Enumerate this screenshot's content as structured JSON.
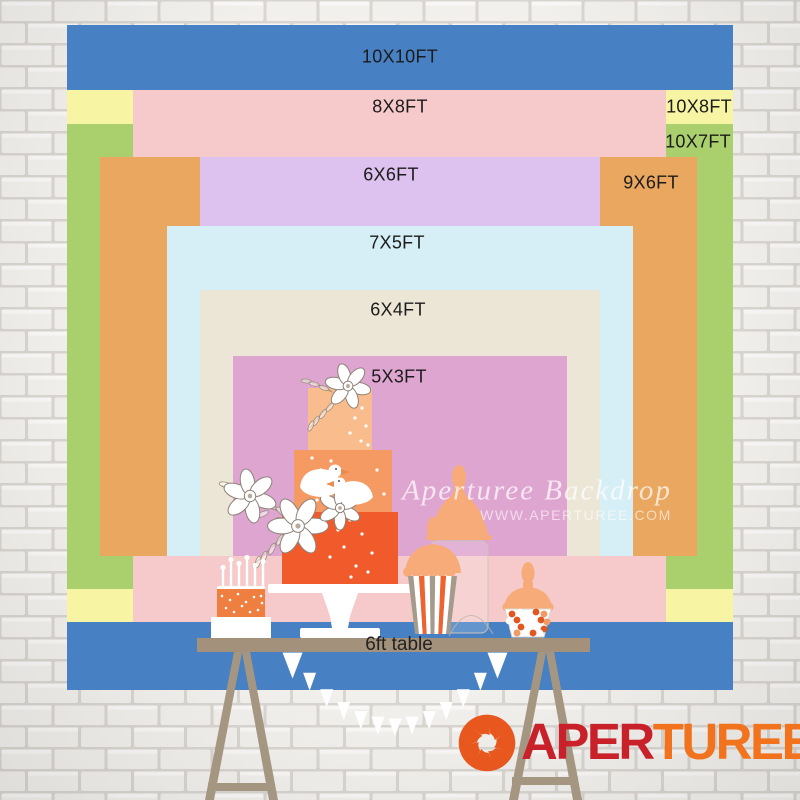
{
  "chart": {
    "unit": "FT",
    "label_color": "#1b1b1b",
    "layers": [
      {
        "id": "10x10",
        "label": "10X10FT",
        "color": "#4781c3",
        "x": 67,
        "y": 25,
        "w": 666,
        "h": 665,
        "label_x": 400,
        "label_y": 57
      },
      {
        "id": "10x8",
        "label": "10X8FT",
        "color": "#f7f5a3",
        "x": 67,
        "y": 90,
        "w": 666,
        "h": 532,
        "label_x": 699,
        "label_y": 107
      },
      {
        "id": "10x7",
        "label": "10X7FT",
        "color": "#aad06e",
        "x": 67,
        "y": 124,
        "w": 666,
        "h": 465,
        "label_x": 698,
        "label_y": 142
      },
      {
        "id": "8x8",
        "label": "8X8FT",
        "color": "#f6caca",
        "x": 133,
        "y": 90,
        "w": 533,
        "h": 532,
        "label_x": 400,
        "label_y": 107
      },
      {
        "id": "9x6",
        "label": "9X6FT",
        "color": "#eaa75f",
        "x": 100,
        "y": 157,
        "w": 597,
        "h": 399,
        "label_x": 651,
        "label_y": 183
      },
      {
        "id": "6x6",
        "label": "6X6FT",
        "color": "#ddc1ee",
        "x": 200,
        "y": 157,
        "w": 400,
        "h": 399,
        "label_x": 391,
        "label_y": 175
      },
      {
        "id": "7x5",
        "label": "7X5FT",
        "color": "#d6eef6",
        "x": 167,
        "y": 226,
        "w": 466,
        "h": 330,
        "label_x": 397,
        "label_y": 243
      },
      {
        "id": "6x4",
        "label": "6X4FT",
        "color": "#ece6d6",
        "x": 200,
        "y": 290,
        "w": 400,
        "h": 266,
        "label_x": 398,
        "label_y": 310
      },
      {
        "id": "5x3",
        "label": "5X3FT",
        "color": "#dea5d0",
        "x": 233,
        "y": 356,
        "w": 334,
        "h": 200,
        "label_x": 399,
        "label_y": 377
      }
    ]
  },
  "watermark": {
    "line1": "Aperturee Backdrop",
    "line2": "WWW.APERTUREE.COM"
  },
  "table": {
    "label": "6ft table",
    "top_color": "#a3917b",
    "leg_color": "#a59681"
  },
  "scene": {
    "cake_top": "#f9bd8d",
    "cake_mid": "#f69a64",
    "cake_bottom": "#f15b2c",
    "small_cake": "#ef7f40",
    "peach": "#f7ab79",
    "stripe_orange": "#ee6430",
    "stripe_gray": "#a49b8d",
    "candy_orange": "#e2571f",
    "candy_light": "#f29a63",
    "bunting": "#ffffff",
    "stand": "#ffffff",
    "outline": "#8e8378"
  },
  "wall": {
    "brick": "#f2f0ed",
    "mortar": "#d9d5d0"
  },
  "logo": {
    "icon": "aperture-icon",
    "icon_color": "#e8581e",
    "text_left": "APER",
    "text_right": "TUREE",
    "color_left": "#c92129",
    "color_right": "#f2731e"
  }
}
